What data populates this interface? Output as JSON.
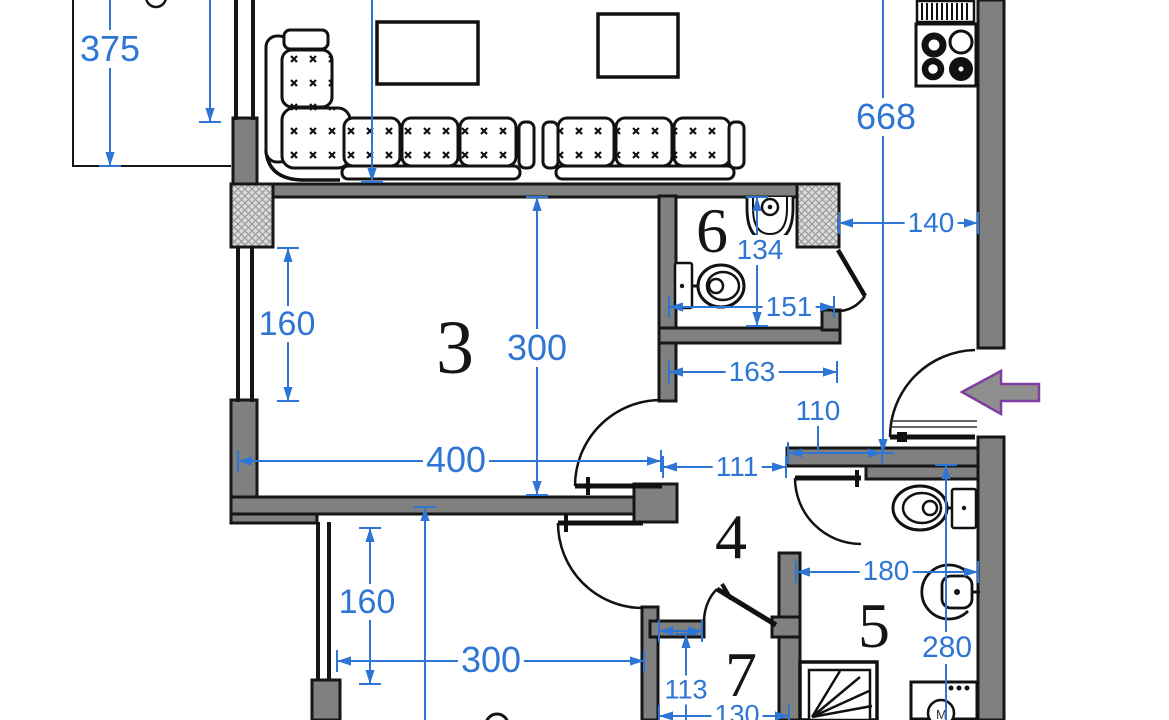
{
  "title": "apartment-floor-plan",
  "colors": {
    "dimension_blue": "#2e75d4",
    "wall_gray": "#808080",
    "wall_black": "#161616",
    "hatch_bg": "#dcdcdc",
    "hatch_line": "#9b9b9b",
    "arrow_fill": "#8f8f8f",
    "arrow_purple": "#7e3fa0"
  },
  "rooms": [
    {
      "id": "room-3",
      "label": "3",
      "x": 455,
      "y": 348,
      "fs": 76
    },
    {
      "id": "room-4",
      "label": "4",
      "x": 731,
      "y": 537,
      "fs": 64
    },
    {
      "id": "room-5",
      "label": "5",
      "x": 874,
      "y": 626,
      "fs": 64
    },
    {
      "id": "room-6",
      "label": "6",
      "x": 712,
      "y": 231,
      "fs": 64
    },
    {
      "id": "room-7",
      "label": "7",
      "x": 741,
      "y": 675,
      "fs": 64
    }
  ],
  "fixture_labels": {
    "washing_machine": "M"
  },
  "fixtures": [
    "corner-sofa",
    "sofa",
    "coffee-table",
    "stove",
    "vent-grille",
    "toilet",
    "sink",
    "bidet",
    "shower",
    "washing-machine",
    "entrance-arrow",
    "window",
    "door"
  ],
  "dimensions": [
    {
      "label": "375",
      "x1": 110,
      "y1": 0,
      "x2": 110,
      "y2": 166,
      "tx": 110,
      "ty": 49,
      "fs": 36,
      "arrows": "end"
    },
    {
      "label": "",
      "x1": 210,
      "y1": 0,
      "x2": 210,
      "y2": 122,
      "arrows": "end"
    },
    {
      "label": "",
      "x1": 372,
      "y1": 0,
      "x2": 372,
      "y2": 182,
      "arrows": "end"
    },
    {
      "label": "668",
      "x1": 883,
      "y1": 0,
      "x2": 883,
      "y2": 453,
      "tx": 886,
      "ty": 117,
      "fs": 36,
      "arrows": "end"
    },
    {
      "label": "140",
      "x1": 839,
      "y1": 223,
      "x2": 978,
      "y2": 223,
      "tx": 931,
      "ty": 223,
      "fs": 28,
      "arrows": "both"
    },
    {
      "label": "134",
      "x1": 757,
      "y1": 197,
      "x2": 757,
      "y2": 326,
      "tx": 760,
      "ty": 250,
      "fs": 28,
      "arrows": "both"
    },
    {
      "label": "300",
      "x1": 537,
      "y1": 197,
      "x2": 537,
      "y2": 495,
      "tx": 537,
      "ty": 348,
      "fs": 36,
      "arrows": "both"
    },
    {
      "label": "160",
      "x1": 288,
      "y1": 248,
      "x2": 288,
      "y2": 401,
      "tx": 287,
      "ty": 324,
      "fs": 34,
      "arrows": "both"
    },
    {
      "label": "151",
      "x1": 669,
      "y1": 307,
      "x2": 834,
      "y2": 307,
      "tx": 789,
      "ty": 307,
      "fs": 28,
      "arrows": "both"
    },
    {
      "label": "163",
      "x1": 669,
      "y1": 372,
      "x2": 837,
      "y2": 372,
      "tx": 752,
      "ty": 372,
      "fs": 28,
      "arrows": "both"
    },
    {
      "label": "110",
      "x1": 788,
      "y1": 453,
      "x2": 882,
      "y2": 453,
      "tx": 818,
      "ty": 411,
      "fs": 28,
      "arrows": "both",
      "leader": [
        818,
        424,
        818,
        451
      ]
    },
    {
      "label": "400",
      "x1": 238,
      "y1": 461,
      "x2": 661,
      "y2": 461,
      "tx": 456,
      "ty": 460,
      "fs": 36,
      "arrows": "both"
    },
    {
      "label": "111",
      "x1": 663,
      "y1": 467,
      "x2": 786,
      "y2": 467,
      "tx": 737,
      "ty": 467,
      "fs": 28,
      "arrows": "both"
    },
    {
      "label": "160",
      "x1": 370,
      "y1": 528,
      "x2": 370,
      "y2": 684,
      "tx": 367,
      "ty": 602,
      "fs": 34,
      "arrows": "both"
    },
    {
      "label": "300",
      "x1": 337,
      "y1": 661,
      "x2": 644,
      "y2": 661,
      "tx": 491,
      "ty": 660,
      "fs": 36,
      "arrows": "both"
    },
    {
      "label": "",
      "x1": 425,
      "y1": 507,
      "x2": 425,
      "y2": 720,
      "arrows": "start"
    },
    {
      "label": "180",
      "x1": 796,
      "y1": 572,
      "x2": 978,
      "y2": 572,
      "tx": 886,
      "ty": 571,
      "fs": 28,
      "arrows": "both"
    },
    {
      "label": "280",
      "x1": 946,
      "y1": 465,
      "x2": 946,
      "y2": 720,
      "tx": 947,
      "ty": 648,
      "fs": 30,
      "arrows": "start"
    },
    {
      "label": "113",
      "x1": 686,
      "y1": 634,
      "x2": 686,
      "y2": 720,
      "tx": 686,
      "ty": 690,
      "fs": 27,
      "arrows": "start"
    },
    {
      "label": "130",
      "x1": 659,
      "y1": 716,
      "x2": 789,
      "y2": 716,
      "tx": 737,
      "ty": 715,
      "fs": 27,
      "arrows": "both"
    },
    {
      "label": "",
      "x1": 659,
      "y1": 631,
      "x2": 702,
      "y2": 631,
      "arrows": "both"
    }
  ]
}
